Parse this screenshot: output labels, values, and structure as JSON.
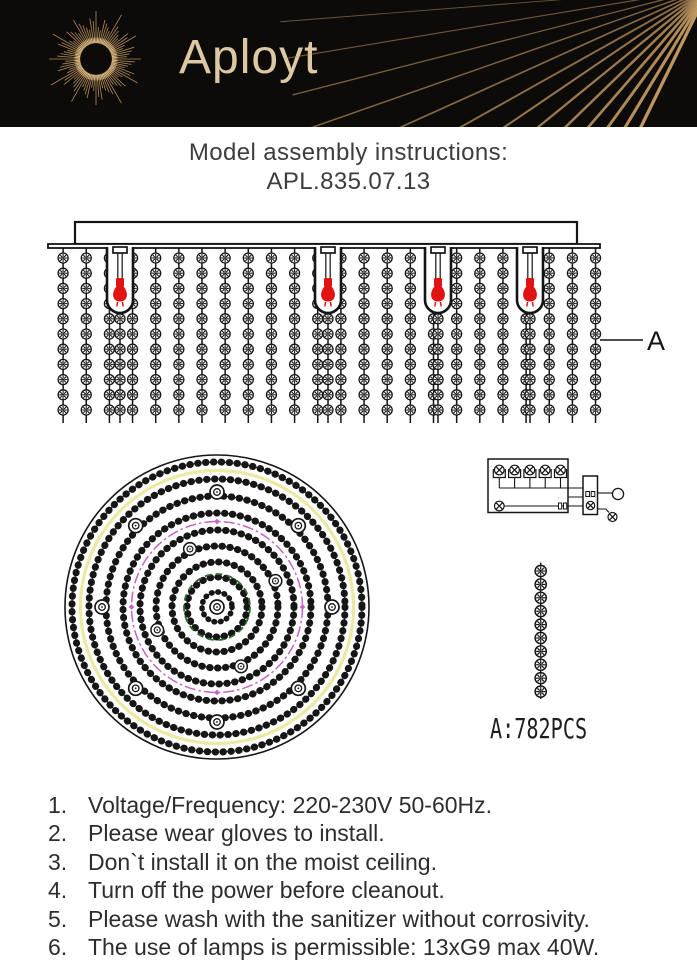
{
  "header": {
    "brand": "Aployt",
    "bg_color": "#0d0a0a",
    "gold_color": "#c59c63",
    "gold_bright": "#dcb87f",
    "brand_text_color": "#dcc8a2"
  },
  "title": {
    "line1": "Model assembly instructions:",
    "line2": "APL.835.07.13"
  },
  "side_view": {
    "part_label": "A",
    "strand_count": 24,
    "beads_per_strand": 11,
    "bulb_positions_x": [
      120,
      328,
      438,
      530
    ],
    "bulb_color": "#e01212",
    "line_color": "#141414"
  },
  "plan_view": {
    "outer_radius": 152,
    "beaded_ring_radii": [
      145,
      128,
      111,
      94,
      77,
      61,
      45,
      30,
      15
    ],
    "accent_yellow": {
      "radius": 136.5,
      "color": "#ece9a2"
    },
    "accent_magenta": {
      "radius": 85.5,
      "color": "#c466c4"
    },
    "accent_green": {
      "radius": 33,
      "color": "#2f6b2f"
    },
    "outer_hole_count": 8,
    "outer_hole_radius": 115,
    "outer_hole_angles": [
      0,
      45,
      90,
      135,
      180,
      225,
      270,
      315
    ],
    "inner_hole_count": 4,
    "inner_hole_radius": 64,
    "inner_hole_angles": [
      24,
      115,
      201,
      292
    ]
  },
  "wiring_diagram": {
    "top_lamp_count": 5,
    "side_lamp_count": 2
  },
  "strand_detail": {
    "bead_count": 10,
    "label": "A:782PCS"
  },
  "instructions": [
    {
      "num": "1.",
      "text": "Voltage/Frequency: 220-230V 50-60Hz."
    },
    {
      "num": "2.",
      "text": "Please wear gloves to install."
    },
    {
      "num": "3.",
      "text": "Don`t install it on the moist ceiling."
    },
    {
      "num": "4.",
      "text": "Turn off the power before cleanout."
    },
    {
      "num": "5.",
      "text": "Please wash with the sanitizer without corrosivity."
    },
    {
      "num": "6.",
      "text": "The use of lamps is permissible: 13xG9 max 40W."
    }
  ]
}
